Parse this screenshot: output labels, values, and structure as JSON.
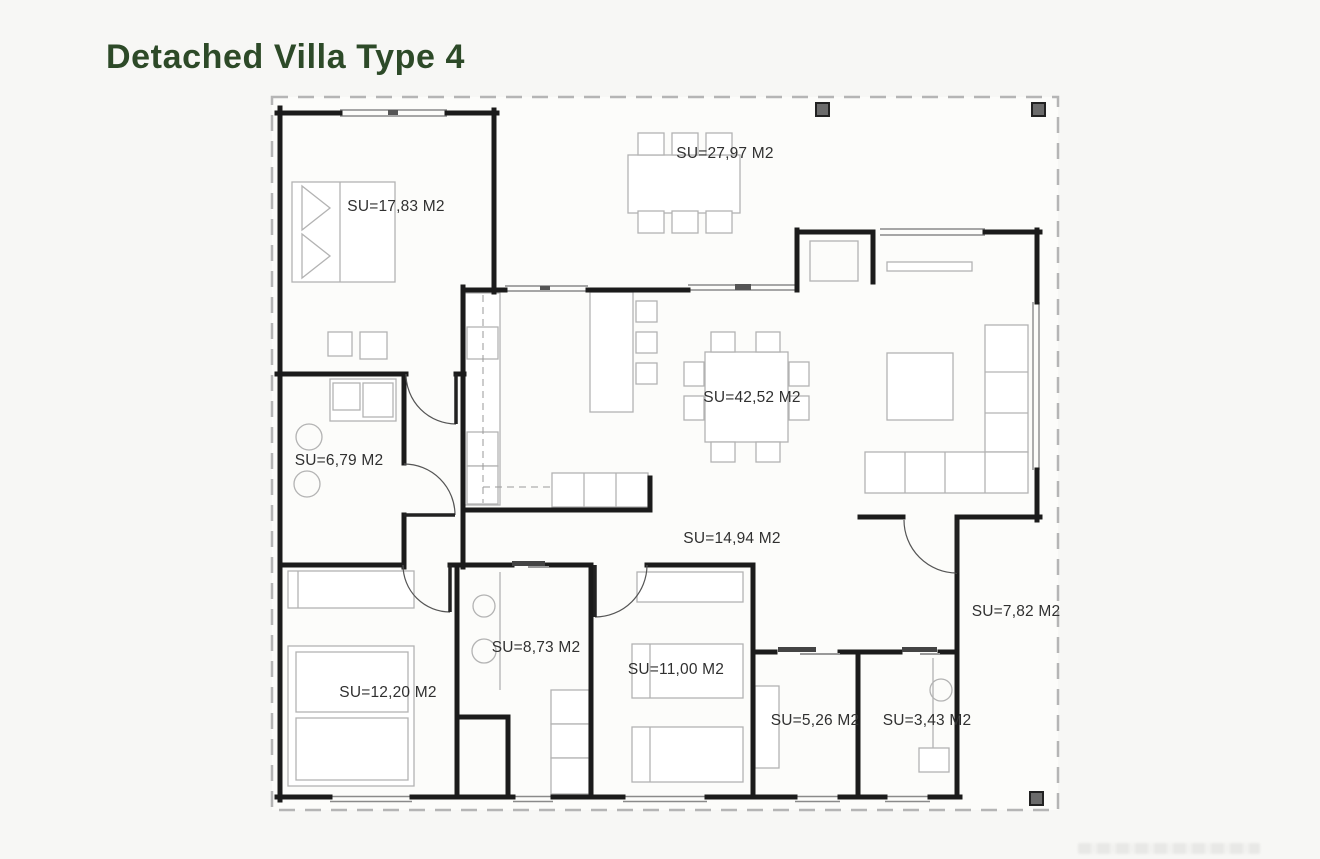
{
  "title": "Detached Villa Type 4",
  "colors": {
    "title": "#2d4a28",
    "walls": "#1b1b1b",
    "furniture": "#b3b3b3",
    "labels": "#303030",
    "roof_outline": "#b5b5b5",
    "pillar_fill": "#6b6b6b"
  },
  "plan": {
    "area_unit": "M2",
    "rooms": [
      {
        "name": "terrace",
        "label": "SU=27,97 M2"
      },
      {
        "name": "master-bedroom",
        "label": "SU=17,83 M2"
      },
      {
        "name": "living-room",
        "label": "SU=42,52 M2"
      },
      {
        "name": "laundry",
        "label": "SU=6,79 M2"
      },
      {
        "name": "hallway",
        "label": "SU=14,94 M2"
      },
      {
        "name": "bathroom",
        "label": "SU=8,73 M2"
      },
      {
        "name": "bedroom-2",
        "label": "SU=12,20 M2"
      },
      {
        "name": "bedroom-3",
        "label": "SU=11,00 M2"
      },
      {
        "name": "utility-room",
        "label": "SU=5,26 M2"
      },
      {
        "name": "wc",
        "label": "SU=3,43 M2"
      },
      {
        "name": "entrance-porch",
        "label": "SU=7,82 M2"
      }
    ]
  }
}
